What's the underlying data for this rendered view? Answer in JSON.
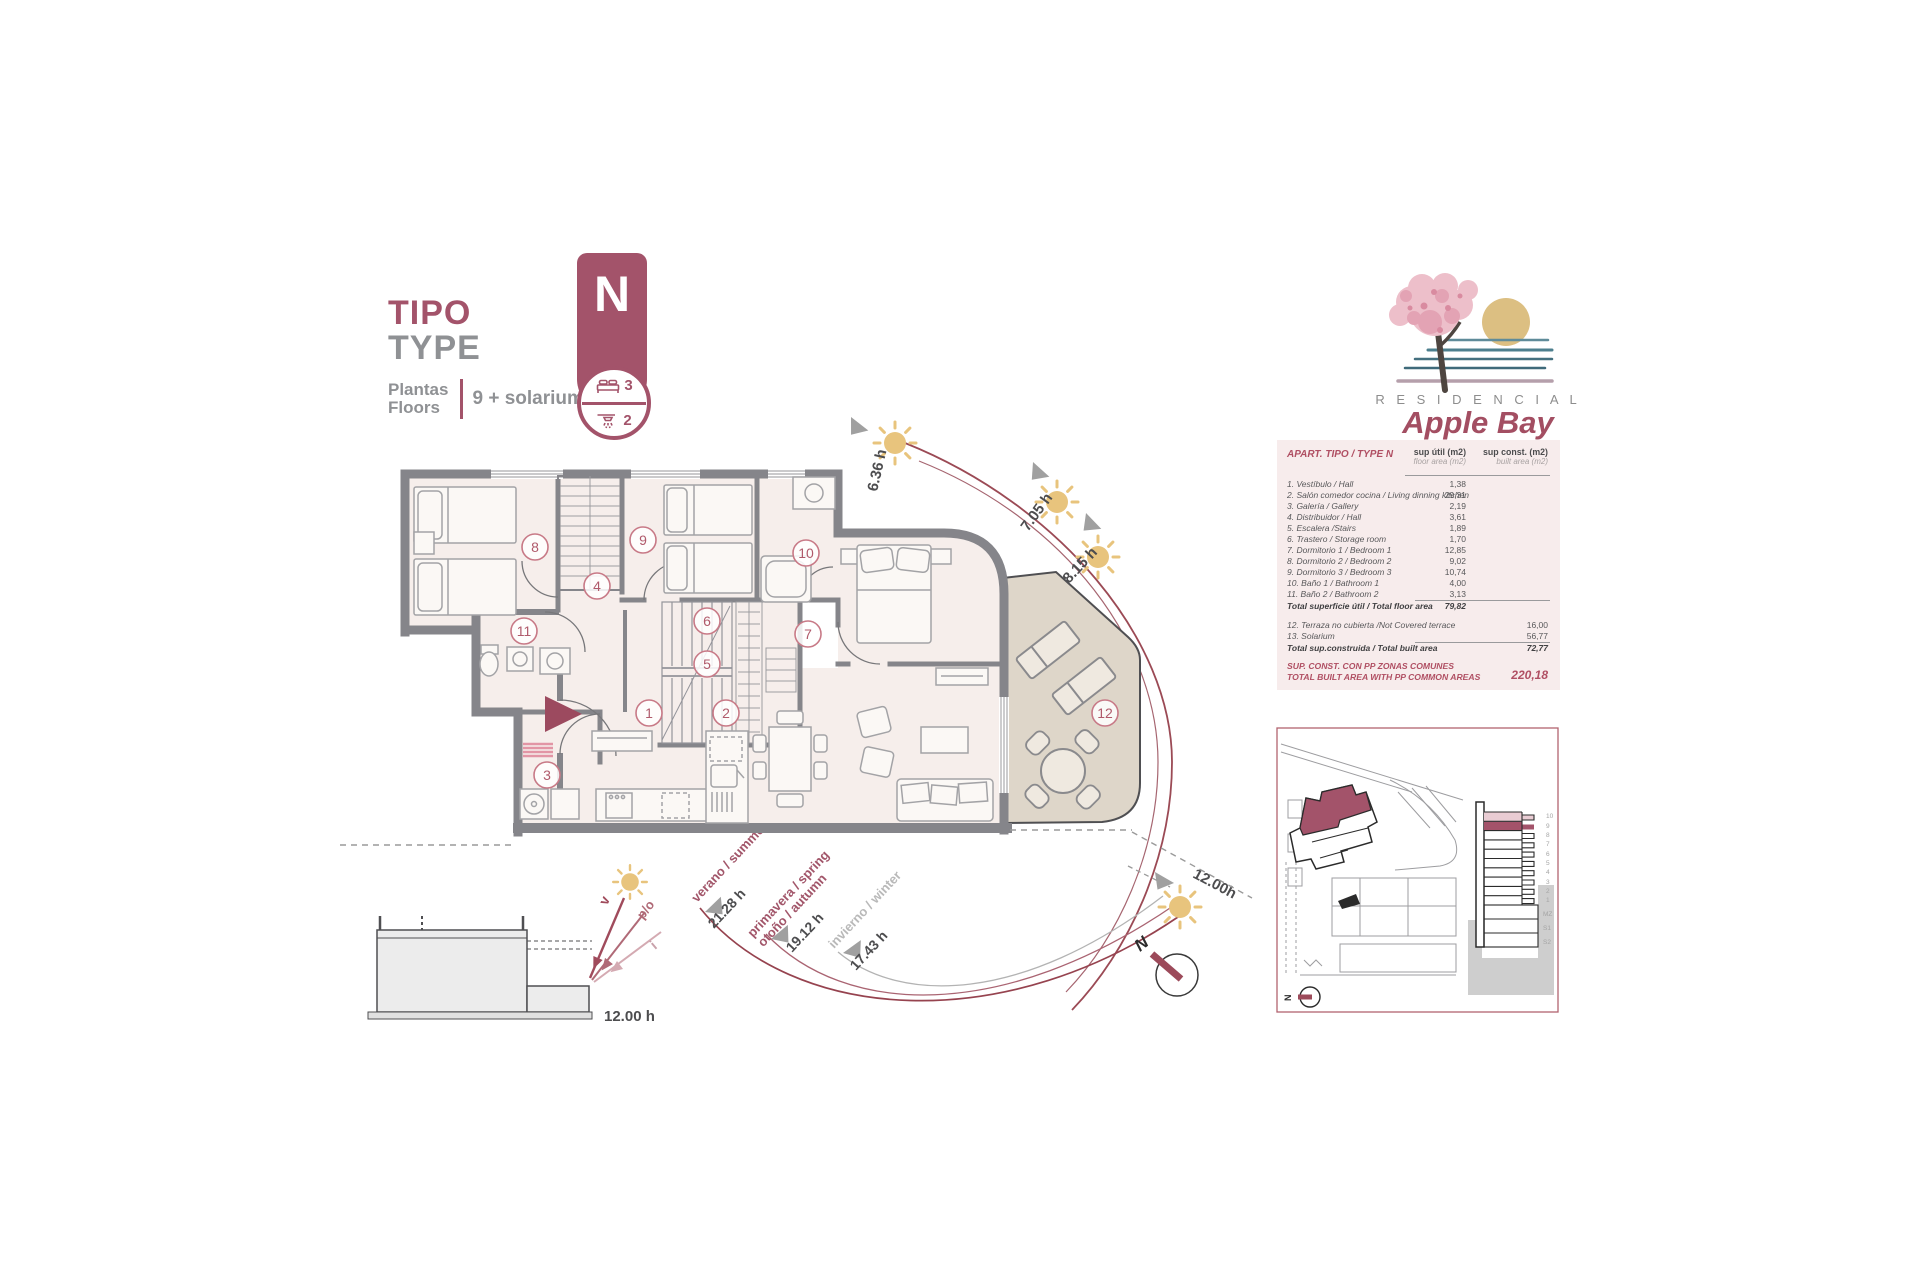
{
  "title": {
    "tipo": "TIPO",
    "type": "TYPE",
    "plantas": "Plantas",
    "floors": "Floors",
    "floors_value": "9 + solarium"
  },
  "badge": {
    "letter": "N",
    "bedrooms": "3",
    "bathrooms": "2"
  },
  "logo": {
    "residencial": "R E S I D E N C I A L",
    "name": "Apple Bay"
  },
  "table": {
    "header": "APART. TIPO / TYPE N",
    "col1_title": "sup útil (m2)",
    "col1_sub": "floor area (m2)",
    "col2_title": "sup const. (m2)",
    "col2_sub": "built area (m2)",
    "rows": [
      {
        "label": "1. Vestíbulo / Hall",
        "util": "1,38"
      },
      {
        "label": "2. Salón comedor cocina / Living dinning kitchen",
        "util": "29,31"
      },
      {
        "label": "3. Galería / Gallery",
        "util": "2,19"
      },
      {
        "label": "4. Distribuidor / Hall",
        "util": "3,61"
      },
      {
        "label": "5. Escalera /Stairs",
        "util": "1,89"
      },
      {
        "label": "6. Trastero / Storage room",
        "util": "1,70"
      },
      {
        "label": "7. Dormitorio 1 / Bedroom 1",
        "util": "12,85"
      },
      {
        "label": "8. Dormitorio 2 / Bedroom 2",
        "util": "9,02"
      },
      {
        "label": "9. Dormitorio 3 / Bedroom 3",
        "util": "10,74"
      },
      {
        "label": "10. Baño 1 / Bathroom 1",
        "util": "4,00"
      },
      {
        "label": "11. Baño 2 / Bathroom 2",
        "util": "3,13"
      }
    ],
    "total_util_label": "Total superficie útil / Total floor area",
    "total_util": "79,82",
    "rows2": [
      {
        "label": "12. Terraza no cubierta /Not Covered terrace",
        "const": "16,00"
      },
      {
        "label": "13. Solarium",
        "const": "56,77"
      }
    ],
    "total_const_label": "Total sup.construida / Total built area",
    "total_const": "72,77",
    "footer_line1": "SUP. CONST. CON PP ZONAS COMUNES",
    "footer_line2": "TOTAL BUILT AREA WITH PP COMMON AREAS",
    "footer_value": "220,18"
  },
  "sun_path": {
    "hours": [
      "6.36 h",
      "7.05 h",
      "8.15 h"
    ],
    "noon": "12.00h",
    "seasons": [
      {
        "label": "verano / summer",
        "hours": "21.28 h"
      },
      {
        "label": "primavera / spring",
        "label2": "otoño / autumn",
        "hours": "19.12 h"
      },
      {
        "label": "invierno / winter",
        "hours": "17.43 h"
      }
    ]
  },
  "section": {
    "v": "v",
    "po": "p/o",
    "i": "i",
    "noon": "12.00 h"
  },
  "compass": {
    "n": "N"
  },
  "site_plan": {
    "compass_n": "N",
    "floor_labels": [
      "10",
      "9",
      "8",
      "7",
      "6",
      "5",
      "4",
      "3",
      "2",
      "1",
      "MZ",
      "S1",
      "S2"
    ]
  },
  "plan": {
    "room_numbers": [
      "1",
      "2",
      "3",
      "4",
      "5",
      "6",
      "7",
      "8",
      "9",
      "10",
      "11",
      "12"
    ]
  },
  "colors": {
    "maroon": "#a3536a",
    "arc": "#9b4a55",
    "sun": "#e8c47d",
    "wall": "#85858a",
    "room": "#f6eeeb",
    "terrace": "#ded6c9"
  }
}
